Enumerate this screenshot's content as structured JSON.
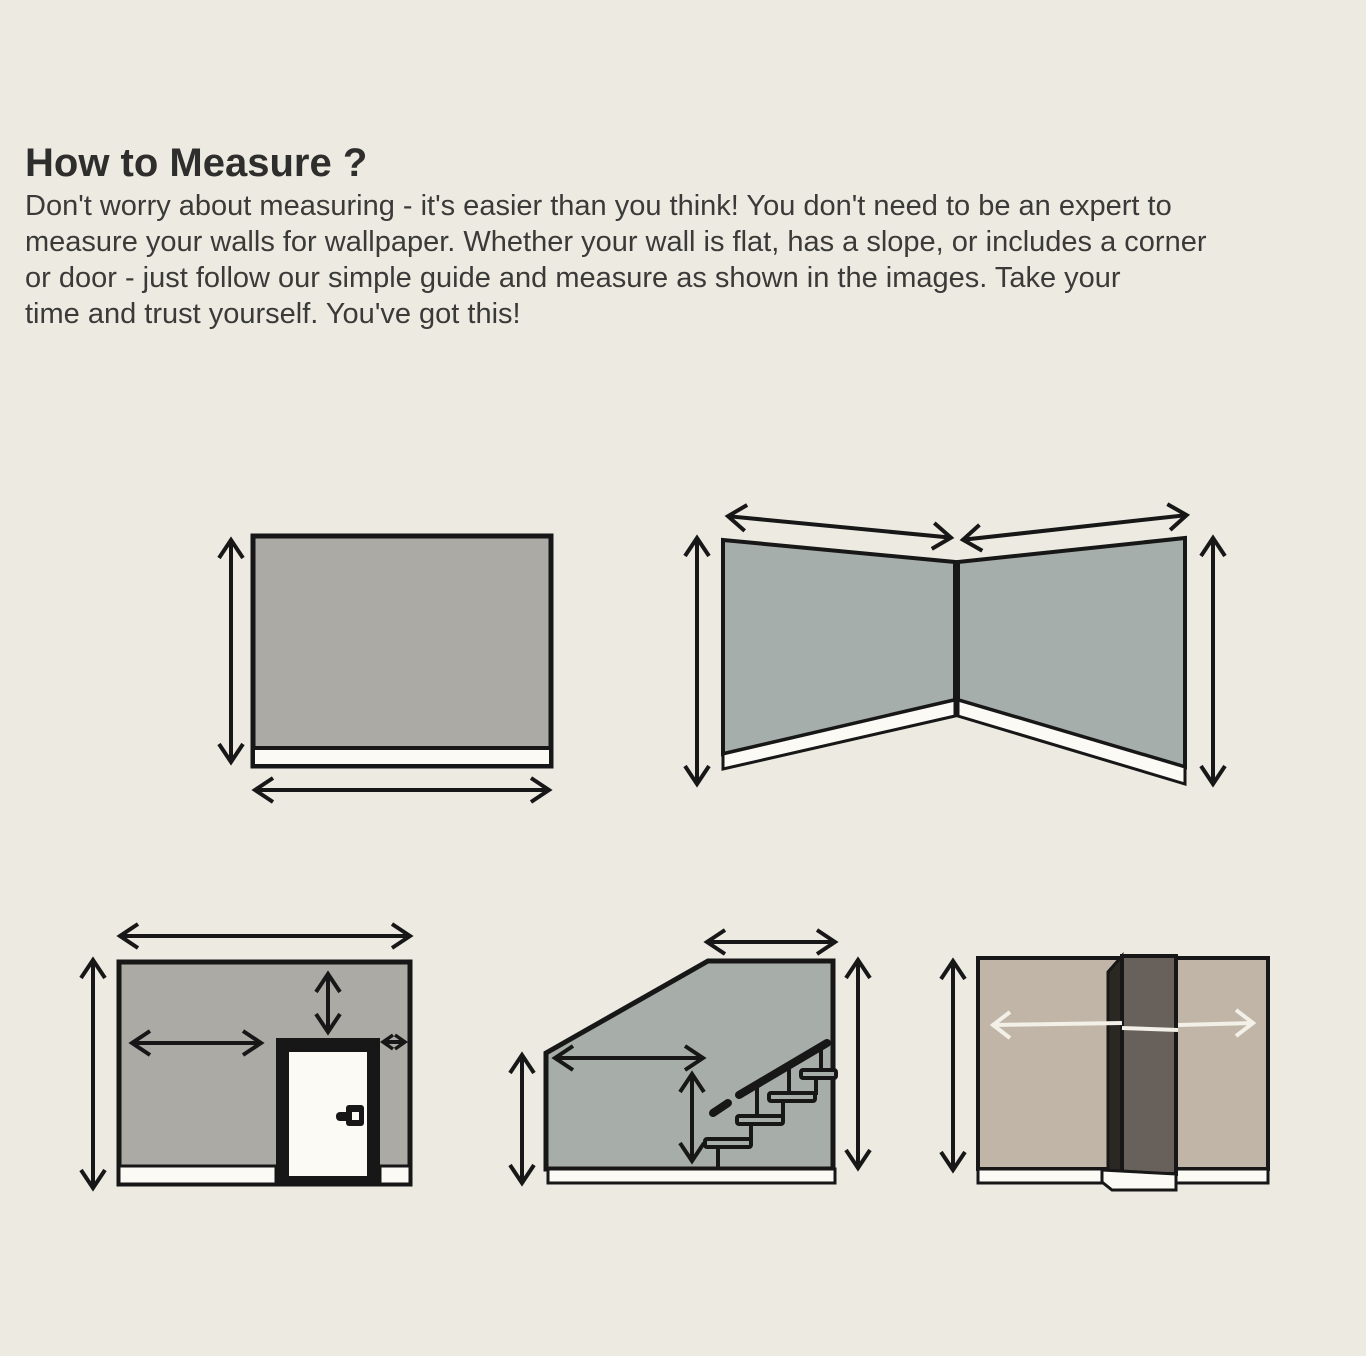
{
  "page": {
    "title": "How to Measure ?",
    "intro_lines": [
      "Don't worry about measuring - it's easier than you think! You don't need to be an expert to",
      "measure your walls for wallpaper. Whether your wall is flat, has a slope, or includes a corner",
      "or door - just follow our simple guide and measure as shown in the images. Take your",
      "time and trust yourself. You've got this!"
    ]
  },
  "colors": {
    "background": "#EDEAE2",
    "ink": "#171717",
    "wall_gray": "#ACAAA5",
    "corner_wall_gray": "#A6AEAB",
    "stairs_wall_gray": "#A7AEA9",
    "tan_wall": "#C0B5A7",
    "column_face": "#67605B",
    "column_side": "#2B2824",
    "trim_white": "#FBFAF5",
    "light_arrow": "#F3F0E7",
    "title_text": "#2E2E2C",
    "body_text": "#3A3A38"
  },
  "diagrams": [
    {
      "id": "flat-wall"
    },
    {
      "id": "corner-wall"
    },
    {
      "id": "wall-with-door"
    },
    {
      "id": "sloped-wall-with-stairs"
    },
    {
      "id": "wall-with-column"
    }
  ]
}
